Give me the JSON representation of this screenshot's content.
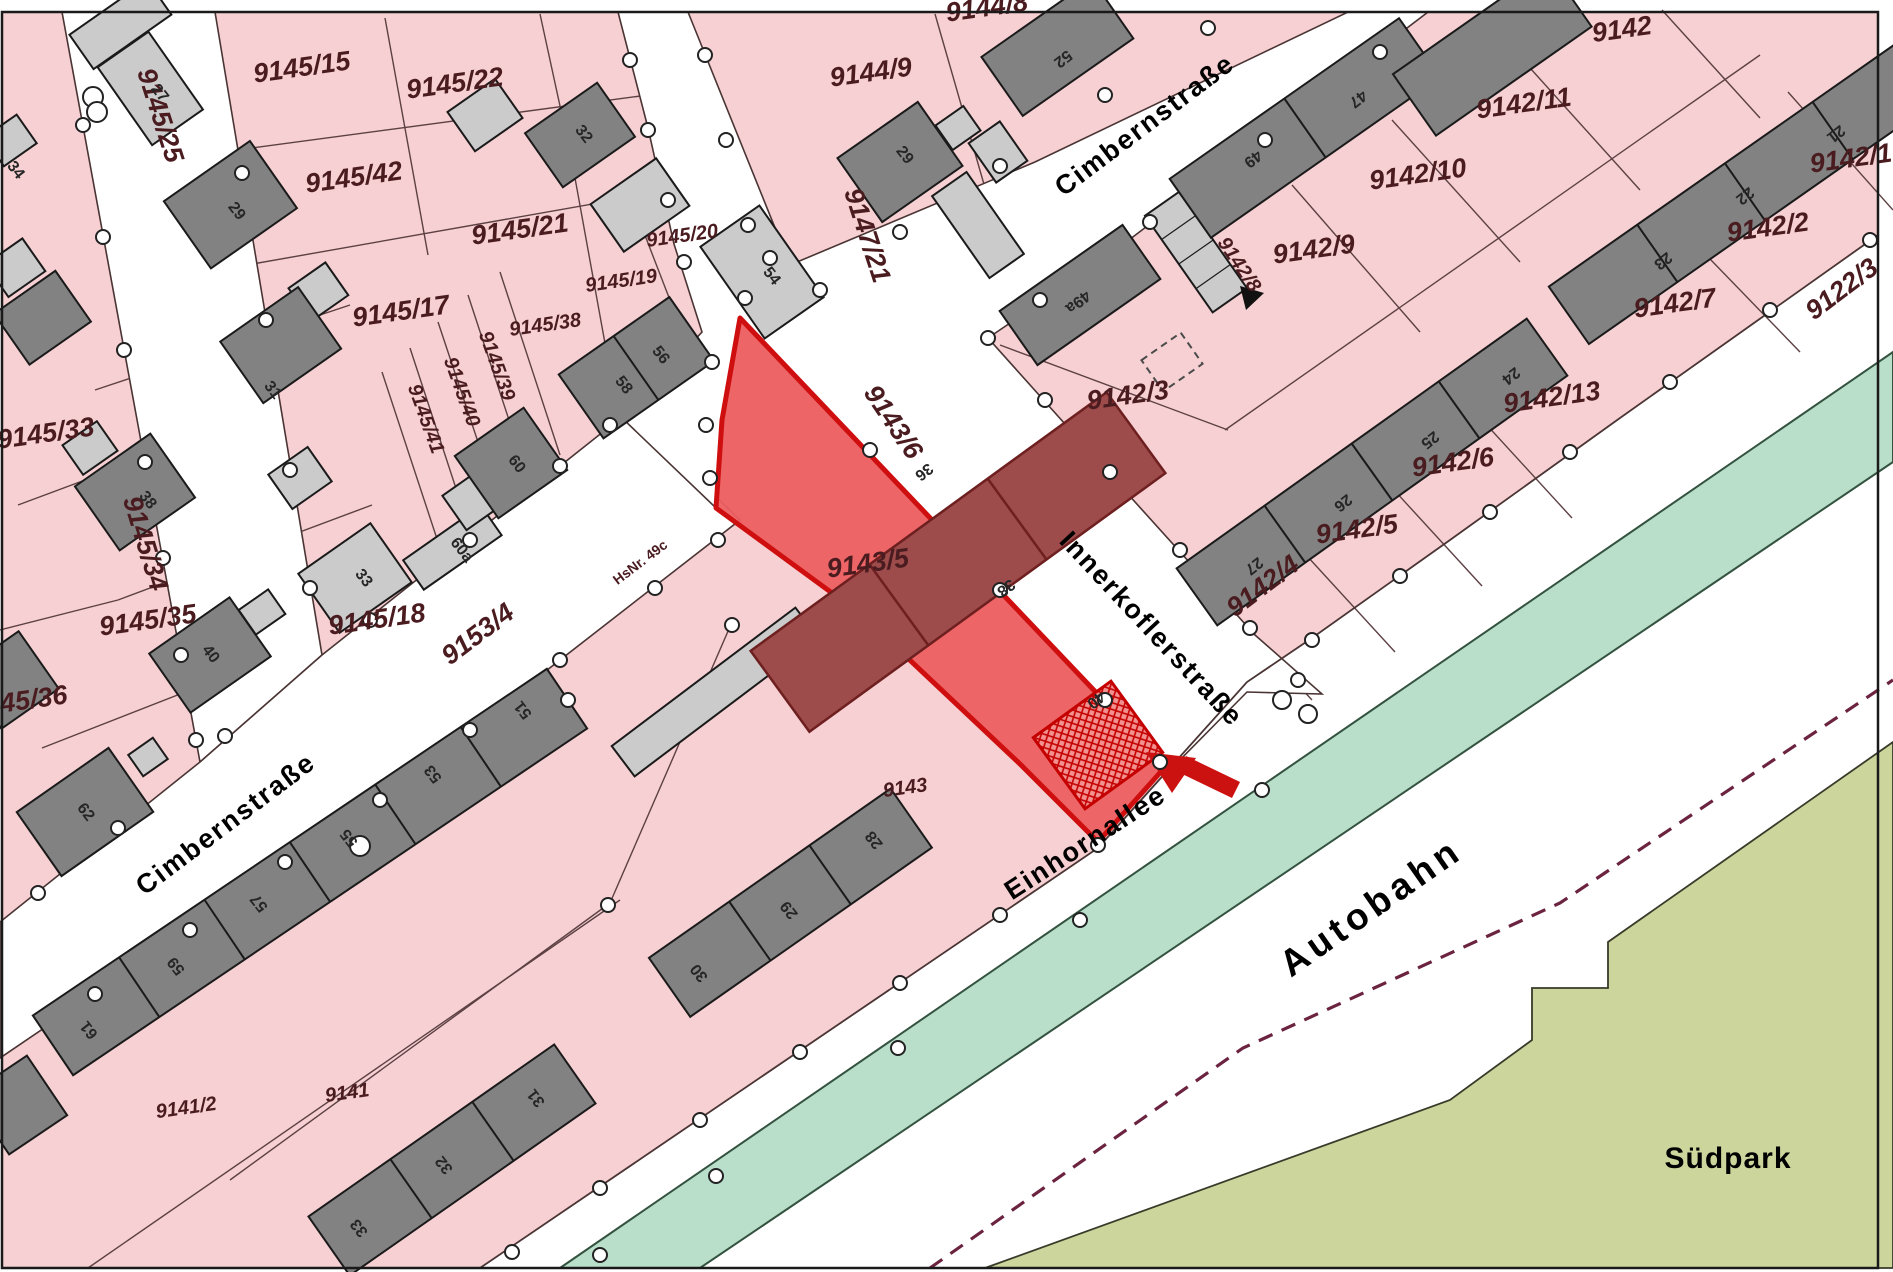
{
  "colors": {
    "parcel_pink": "#f6d0d2",
    "street_white": "#ffffff",
    "building_dark": "#828282",
    "building_light": "#cbcbcb",
    "highlight_red": "#ec5f60",
    "highlight_border": "#cf0f0f",
    "building_dark_red": "#9d4b4b",
    "green_strip": "#b9dec9",
    "park_olive": "#ccd69c",
    "label_maroon": "#4a1c20",
    "arrow_red": "#cc1111"
  },
  "map": {
    "highlighted_parcel": "9143/5",
    "parcel_labels": [
      {
        "text": "9145/25",
        "x": 152,
        "y": 118,
        "rot": 72,
        "size": "lg"
      },
      {
        "text": "9145/15",
        "x": 303,
        "y": 76,
        "rot": -8,
        "size": "lg"
      },
      {
        "text": "9145/22",
        "x": 456,
        "y": 92,
        "rot": -8,
        "size": "lg"
      },
      {
        "text": "9145/42",
        "x": 355,
        "y": 186,
        "rot": -8,
        "size": "lg"
      },
      {
        "text": "9145/21",
        "x": 521,
        "y": 238,
        "rot": -8,
        "size": "lg"
      },
      {
        "text": "9145/20",
        "x": 683,
        "y": 242,
        "rot": -8,
        "size": "sm"
      },
      {
        "text": "9145/19",
        "x": 622,
        "y": 287,
        "rot": -8,
        "size": "sm"
      },
      {
        "text": "9145/38",
        "x": 546,
        "y": 331,
        "rot": -8,
        "size": "sm"
      },
      {
        "text": "9145/39",
        "x": 491,
        "y": 368,
        "rot": 70,
        "size": "sm"
      },
      {
        "text": "9145/40",
        "x": 456,
        "y": 394,
        "rot": 70,
        "size": "sm"
      },
      {
        "text": "9145/41",
        "x": 420,
        "y": 421,
        "rot": 70,
        "size": "sm"
      },
      {
        "text": "9145/17",
        "x": 402,
        "y": 320,
        "rot": -8,
        "size": "lg"
      },
      {
        "text": "9145/33",
        "x": 47,
        "y": 442,
        "rot": -8,
        "size": "lg"
      },
      {
        "text": "9145/34",
        "x": 137,
        "y": 546,
        "rot": 73,
        "size": "lg"
      },
      {
        "text": "9145/35",
        "x": 149,
        "y": 629,
        "rot": -8,
        "size": "lg"
      },
      {
        "text": "9145/36",
        "x": 20,
        "y": 710,
        "rot": -8,
        "size": "lg"
      },
      {
        "text": "9145/18",
        "x": 378,
        "y": 628,
        "rot": -8,
        "size": "lg"
      },
      {
        "text": "9153/4",
        "x": 483,
        "y": 641,
        "rot": -37,
        "size": "lg"
      },
      {
        "text": "9147/21",
        "x": 859,
        "y": 238,
        "rot": 72,
        "size": "lg"
      },
      {
        "text": "9144/9",
        "x": 872,
        "y": 81,
        "rot": -8,
        "size": "lg"
      },
      {
        "text": "9144/8",
        "x": 988,
        "y": 16,
        "rot": -8,
        "size": "lg"
      },
      {
        "text": "9142",
        "x": 1623,
        "y": 38,
        "rot": -8,
        "size": "lg"
      },
      {
        "text": "9142/11",
        "x": 1525,
        "y": 112,
        "rot": -8,
        "size": "lg"
      },
      {
        "text": "9142/10",
        "x": 1419,
        "y": 183,
        "rot": -8,
        "size": "lg"
      },
      {
        "text": "9142/9",
        "x": 1315,
        "y": 258,
        "rot": -8,
        "size": "lg"
      },
      {
        "text": "9142/8",
        "x": 1234,
        "y": 268,
        "rot": 56,
        "size": "sm"
      },
      {
        "text": "9142/3",
        "x": 1129,
        "y": 404,
        "rot": -8,
        "size": "lg"
      },
      {
        "text": "9143/6",
        "x": 886,
        "y": 427,
        "rot": 56,
        "size": "lg"
      },
      {
        "text": "9142/1",
        "x": 1852,
        "y": 167,
        "rot": -8,
        "size": "lg"
      },
      {
        "text": "9142/2",
        "x": 1769,
        "y": 236,
        "rot": -8,
        "size": "lg"
      },
      {
        "text": "9142/7",
        "x": 1676,
        "y": 312,
        "rot": -8,
        "size": "lg"
      },
      {
        "text": "9122/3",
        "x": 1847,
        "y": 296,
        "rot": -37,
        "size": "lg"
      },
      {
        "text": "9142/13",
        "x": 1553,
        "y": 406,
        "rot": -8,
        "size": "lg"
      },
      {
        "text": "9142/6",
        "x": 1454,
        "y": 471,
        "rot": -8,
        "size": "lg"
      },
      {
        "text": "9142/5",
        "x": 1358,
        "y": 538,
        "rot": -8,
        "size": "lg"
      },
      {
        "text": "9142/4",
        "x": 1268,
        "y": 593,
        "rot": -37,
        "size": "lg"
      },
      {
        "text": "9143/5",
        "x": 869,
        "y": 572,
        "rot": -8,
        "size": "lg"
      },
      {
        "text": "9143",
        "x": 906,
        "y": 794,
        "rot": -8,
        "size": "sm"
      },
      {
        "text": "9141",
        "x": 348,
        "y": 1099,
        "rot": -8,
        "size": "sm"
      },
      {
        "text": "9141/2",
        "x": 187,
        "y": 1114,
        "rot": -8,
        "size": "sm"
      },
      {
        "text": "HsNr. 49c",
        "x": 643,
        "y": 566,
        "rot": -37,
        "size": "xs"
      }
    ],
    "street_labels": [
      {
        "text": "Cimbernstraße",
        "x": 1150,
        "y": 132,
        "rot": -37,
        "size": "st"
      },
      {
        "text": "Cimbernstraße",
        "x": 231,
        "y": 831,
        "rot": -37,
        "size": "st"
      },
      {
        "text": "Innerkoflerstraße",
        "x": 1145,
        "y": 635,
        "rot": 47,
        "size": "st"
      },
      {
        "text": "Einhornallee",
        "x": 1090,
        "y": 850,
        "rot": -33,
        "size": "st"
      },
      {
        "text": "Autobahn",
        "x": 1378,
        "y": 917,
        "rot": -35,
        "size": "xl"
      },
      {
        "text": "Südpark",
        "x": 1728,
        "y": 1168,
        "rot": 0,
        "size": "sp"
      }
    ],
    "house_numbers": [
      {
        "text": "27",
        "x": 156,
        "y": 96,
        "rot": 52
      },
      {
        "text": "34",
        "x": 12,
        "y": 173,
        "rot": 52
      },
      {
        "text": "29",
        "x": 233,
        "y": 214,
        "rot": 52
      },
      {
        "text": "31",
        "x": 269,
        "y": 393,
        "rot": 52
      },
      {
        "text": "38",
        "x": 144,
        "y": 503,
        "rot": 52
      },
      {
        "text": "33",
        "x": 360,
        "y": 581,
        "rot": 52
      },
      {
        "text": "40",
        "x": 207,
        "y": 657,
        "rot": 52
      },
      {
        "text": "62",
        "x": 82,
        "y": 815,
        "rot": 52
      },
      {
        "text": "32",
        "x": 580,
        "y": 137,
        "rot": 52
      },
      {
        "text": "54",
        "x": 768,
        "y": 279,
        "rot": 52
      },
      {
        "text": "56",
        "x": 657,
        "y": 358,
        "rot": 52
      },
      {
        "text": "58",
        "x": 620,
        "y": 388,
        "rot": 52
      },
      {
        "text": "60",
        "x": 513,
        "y": 467,
        "rot": 52
      },
      {
        "text": "60a",
        "x": 458,
        "y": 553,
        "rot": 52
      },
      {
        "text": "52",
        "x": 1060,
        "y": 55,
        "rot": 142
      },
      {
        "text": "29",
        "x": 901,
        "y": 158,
        "rot": 52
      },
      {
        "text": "49a",
        "x": 1075,
        "y": 298,
        "rot": 142
      },
      {
        "text": "49",
        "x": 1250,
        "y": 155,
        "rot": 142
      },
      {
        "text": "47",
        "x": 1355,
        "y": 95,
        "rot": 142
      },
      {
        "text": "21",
        "x": 1833,
        "y": 130,
        "rot": 142
      },
      {
        "text": "22",
        "x": 1742,
        "y": 192,
        "rot": 142
      },
      {
        "text": "23",
        "x": 1660,
        "y": 257,
        "rot": 142
      },
      {
        "text": "24",
        "x": 1508,
        "y": 372,
        "rot": 142
      },
      {
        "text": "25",
        "x": 1427,
        "y": 436,
        "rot": 142
      },
      {
        "text": "26",
        "x": 1340,
        "y": 499,
        "rot": 142
      },
      {
        "text": "27",
        "x": 1251,
        "y": 562,
        "rot": 142
      },
      {
        "text": "36",
        "x": 921,
        "y": 468,
        "rot": 142
      },
      {
        "text": "38",
        "x": 1003,
        "y": 584,
        "rot": 142
      },
      {
        "text": "40",
        "x": 1093,
        "y": 696,
        "rot": 142
      },
      {
        "text": "51",
        "x": 527,
        "y": 707,
        "rot": 232
      },
      {
        "text": "53",
        "x": 437,
        "y": 771,
        "rot": 232
      },
      {
        "text": "55",
        "x": 353,
        "y": 835,
        "rot": 232
      },
      {
        "text": "57",
        "x": 263,
        "y": 900,
        "rot": 232
      },
      {
        "text": "59",
        "x": 180,
        "y": 963,
        "rot": 232
      },
      {
        "text": "61",
        "x": 93,
        "y": 1027,
        "rot": 232
      },
      {
        "text": "28",
        "x": 878,
        "y": 837,
        "rot": 232
      },
      {
        "text": "29",
        "x": 793,
        "y": 907,
        "rot": 232
      },
      {
        "text": "30",
        "x": 703,
        "y": 970,
        "rot": 232
      },
      {
        "text": "31",
        "x": 540,
        "y": 1095,
        "rot": 232
      },
      {
        "text": "32",
        "x": 448,
        "y": 1162,
        "rot": 232
      },
      {
        "text": "33",
        "x": 363,
        "y": 1225,
        "rot": 232
      }
    ]
  }
}
